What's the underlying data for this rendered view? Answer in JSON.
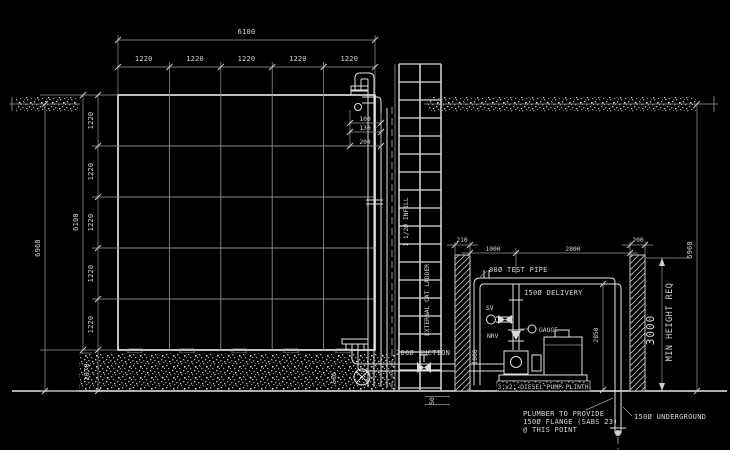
{
  "colors": {
    "background": "#000000",
    "line_bright": "#e8e8e8",
    "line_dim": "#9a9a9a",
    "text": "#d6d6d6"
  },
  "drawing": {
    "top": {
      "overall": "6100",
      "segments": [
        "1220",
        "1220",
        "1220",
        "1220",
        "1220"
      ]
    },
    "left": {
      "overall": "6960",
      "tank_height": "6100",
      "segments": [
        "1220",
        "1220",
        "1220",
        "1220",
        "1220"
      ],
      "plinth": "1070"
    },
    "right": {
      "overall": "6960"
    },
    "nozzle_dims": {
      "d1": "100",
      "d2": "130",
      "d3": "200"
    },
    "ladder": {
      "label": "EXTERNAL CAT LADDER",
      "infill": "1 1/2Ø INFILL"
    },
    "suction": {
      "label": "200Ø SUCTION",
      "drop": "580",
      "screed": "50"
    },
    "pump_room": {
      "dims": [
        "210",
        "1000",
        "2800",
        "200"
      ],
      "test_pipe": "80Ø TEST PIPE",
      "delivery": "150Ø DELIVERY",
      "delivery_height": "2850",
      "height_req_value": "3000",
      "height_req_label": "MIN HEIGHT REQ",
      "suction_height": "1000",
      "sv": "SV",
      "nrv": "NRV",
      "gauge": "GAUGE",
      "plinth_label": "3'x2' DIESEL PUMP PLINTH"
    },
    "notes": {
      "plumber_line1": "PLUMBER TO PROVIDE",
      "plumber_line2": "150Ø FLANGE (SABS 23)",
      "plumber_line3": "@ THIS POINT",
      "underground": "150Ø UNDERGROUND"
    }
  }
}
